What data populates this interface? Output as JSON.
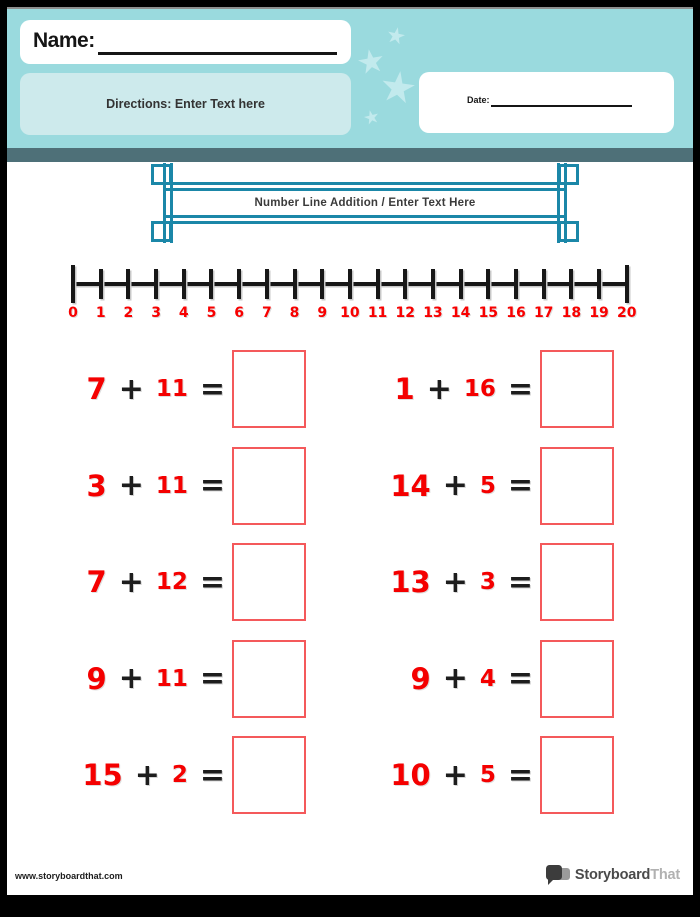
{
  "header": {
    "name_label": "Name:",
    "directions_text": "Directions: Enter Text here",
    "date_label": "Date:"
  },
  "banner": {
    "title": "Number Line Addition / Enter Text Here"
  },
  "number_line": {
    "labels": [
      "0",
      "1",
      "2",
      "3",
      "4",
      "5",
      "6",
      "7",
      "8",
      "9",
      "10",
      "11",
      "12",
      "13",
      "14",
      "15",
      "16",
      "17",
      "18",
      "19",
      "20"
    ],
    "min": 0,
    "max": 20
  },
  "problems": {
    "plus_sign": "+",
    "equals_sign": "=",
    "columns": [
      [
        {
          "a": "7",
          "b": "11"
        },
        {
          "a": "3",
          "b": "11"
        },
        {
          "a": "7",
          "b": "12"
        },
        {
          "a": "9",
          "b": "11"
        },
        {
          "a": "15",
          "b": "2"
        }
      ],
      [
        {
          "a": "1",
          "b": "16"
        },
        {
          "a": "14",
          "b": "5"
        },
        {
          "a": "13",
          "b": "3"
        },
        {
          "a": "9",
          "b": "4"
        },
        {
          "a": "10",
          "b": "5"
        }
      ]
    ]
  },
  "footer": {
    "url": "www.storyboardthat.com",
    "logo_primary": "Storyboard",
    "logo_secondary": "That"
  },
  "colors": {
    "header_teal": "#9adade",
    "directions_teal": "#cdeaec",
    "star_teal": "#c2eaed",
    "divider_slate": "#4e7078",
    "frame_teal": "#1b87a8",
    "number_red": "#f40000",
    "box_border_red": "#f4595b",
    "ink_black": "#1d1d1d"
  }
}
